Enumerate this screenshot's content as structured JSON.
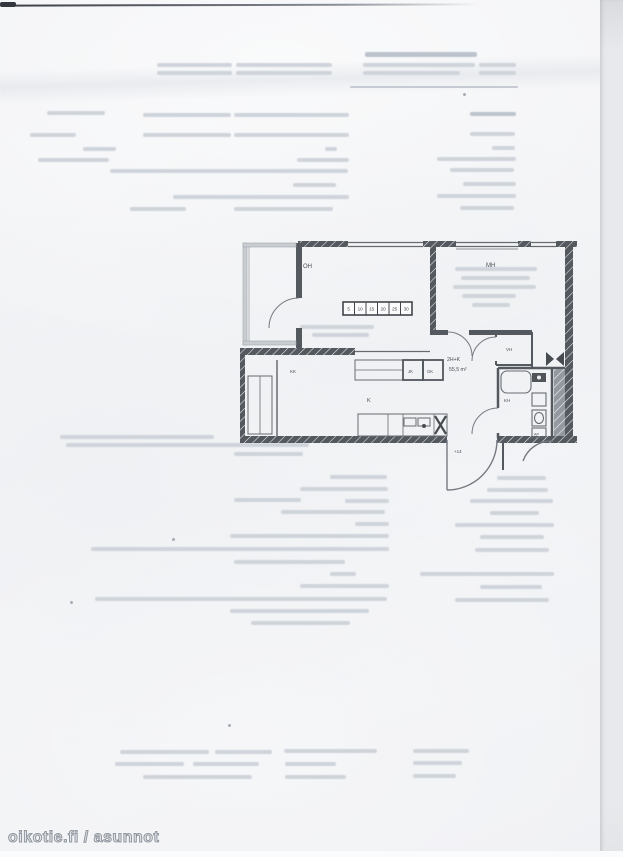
{
  "scan": {
    "watermark": "oikotie.fi / asunnot",
    "page_color": "#f2f3f5",
    "edge_strip_color": "#e7e9ec",
    "ink_color": "#45494f"
  },
  "floorplan": {
    "unit_type": "2H+K",
    "unit_area": "55,5 m²",
    "entry_level_mark": "+14",
    "room_labels": {
      "living": "OH",
      "bedroom": "MH",
      "kitchen": "K",
      "kitchenette": "KK",
      "closet": "VH",
      "bathroom": "KH",
      "fridge": "JK",
      "freezer": "GK",
      "appliance": "AP"
    },
    "scale_bar": {
      "values": [
        "5",
        "10",
        "15",
        "20",
        "25",
        "30"
      ]
    }
  },
  "ghost_text": {
    "note_color": "#cfd4db",
    "rows": [
      [
        365,
        52,
        112,
        5,
        "d"
      ],
      [
        363,
        63,
        112
      ],
      [
        479,
        63,
        37
      ],
      [
        363,
        71,
        97
      ],
      [
        479,
        71,
        37
      ],
      [
        157,
        63,
        75
      ],
      [
        236,
        63,
        96
      ],
      [
        157,
        71,
        75
      ],
      [
        236,
        71,
        96
      ],
      [
        350,
        86,
        168,
        2,
        "r"
      ],
      [
        47,
        111,
        58
      ],
      [
        143,
        113,
        88
      ],
      [
        234,
        113,
        115
      ],
      [
        470,
        112,
        46,
        4,
        "d"
      ],
      [
        30,
        133,
        46
      ],
      [
        143,
        133,
        88
      ],
      [
        234,
        133,
        115
      ],
      [
        470,
        132,
        45
      ],
      [
        83,
        147,
        33
      ],
      [
        325,
        147,
        12
      ],
      [
        492,
        146,
        23
      ],
      [
        38,
        158,
        71
      ],
      [
        297,
        158,
        52
      ],
      [
        437,
        157,
        79
      ],
      [
        110,
        169,
        238
      ],
      [
        450,
        168,
        64
      ],
      [
        293,
        183,
        43
      ],
      [
        463,
        182,
        53
      ],
      [
        173,
        195,
        176
      ],
      [
        437,
        194,
        79
      ],
      [
        130,
        207,
        56
      ],
      [
        234,
        207,
        99
      ],
      [
        460,
        206,
        54
      ],
      [
        455,
        267,
        82
      ],
      [
        461,
        276,
        69
      ],
      [
        453,
        285,
        83
      ],
      [
        462,
        294,
        54
      ],
      [
        472,
        303,
        38
      ],
      [
        300,
        325,
        74
      ],
      [
        312,
        333,
        57
      ],
      [
        60,
        435,
        154
      ],
      [
        66,
        443,
        243
      ],
      [
        234,
        452,
        69
      ],
      [
        330,
        475,
        57
      ],
      [
        497,
        476,
        49
      ],
      [
        300,
        487,
        88
      ],
      [
        487,
        488,
        61
      ],
      [
        234,
        498,
        67
      ],
      [
        345,
        499,
        44
      ],
      [
        470,
        499,
        83
      ],
      [
        281,
        510,
        104
      ],
      [
        490,
        511,
        49
      ],
      [
        355,
        522,
        34
      ],
      [
        455,
        523,
        99
      ],
      [
        230,
        534,
        159
      ],
      [
        480,
        535,
        64
      ],
      [
        91,
        547,
        298
      ],
      [
        475,
        548,
        74
      ],
      [
        234,
        560,
        111
      ],
      [
        330,
        572,
        26
      ],
      [
        420,
        572,
        134
      ],
      [
        300,
        584,
        89
      ],
      [
        480,
        585,
        62
      ],
      [
        95,
        597,
        292
      ],
      [
        455,
        598,
        94
      ],
      [
        230,
        609,
        139
      ],
      [
        251,
        621,
        99
      ],
      [
        120,
        750,
        89
      ],
      [
        215,
        750,
        57
      ],
      [
        284,
        749,
        93
      ],
      [
        413,
        749,
        56
      ],
      [
        115,
        762,
        69
      ],
      [
        193,
        762,
        66
      ],
      [
        285,
        762,
        51
      ],
      [
        413,
        761,
        49
      ],
      [
        143,
        775,
        109
      ],
      [
        285,
        775,
        61
      ],
      [
        413,
        774,
        43
      ]
    ],
    "specks": [
      [
        172,
        538
      ],
      [
        70,
        601
      ],
      [
        228,
        724
      ],
      [
        463,
        93
      ]
    ]
  }
}
